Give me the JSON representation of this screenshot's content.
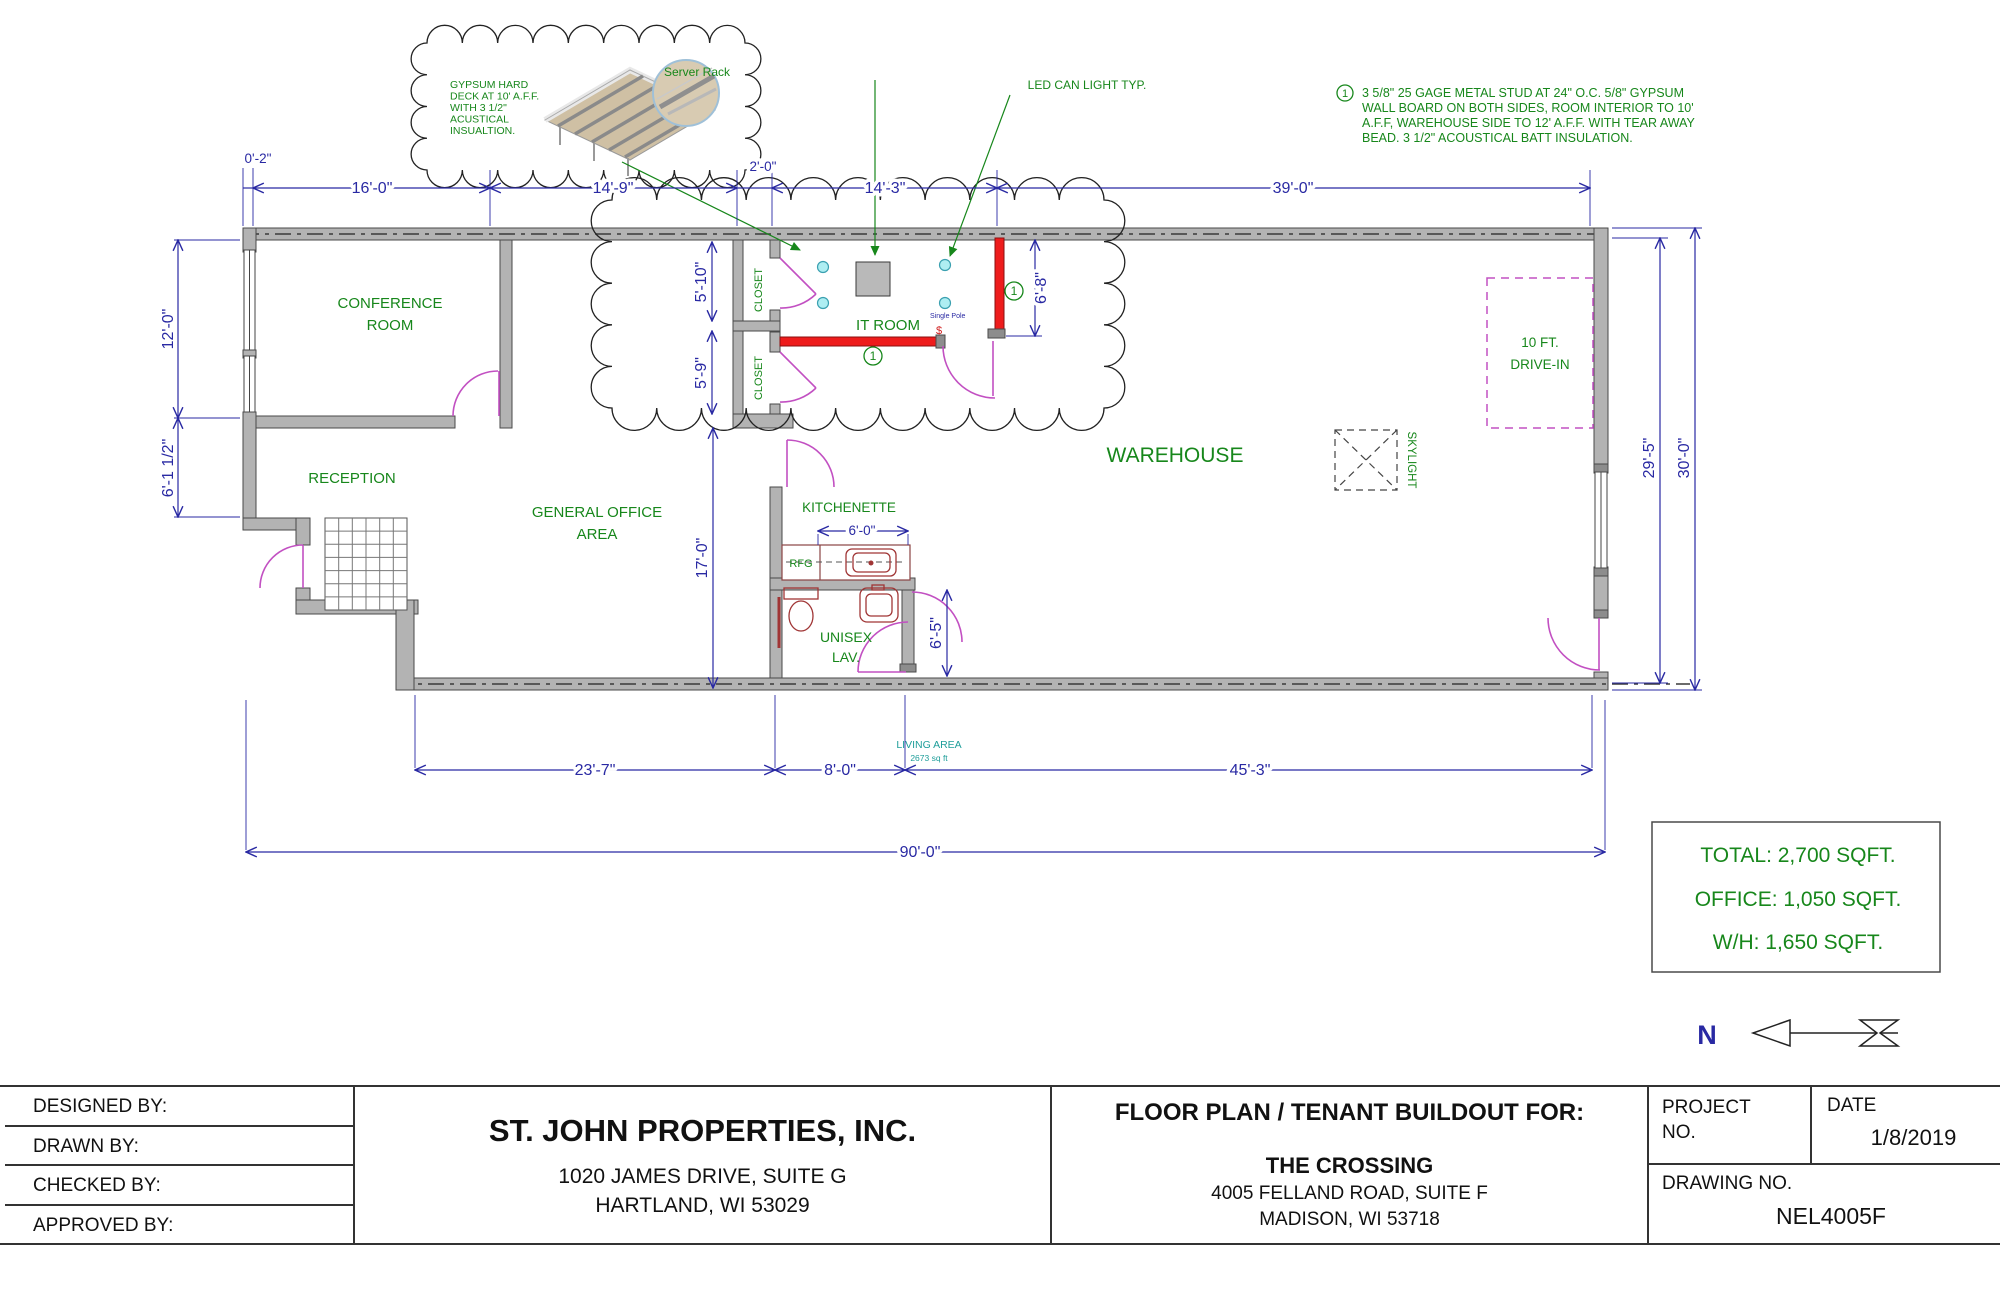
{
  "colors": {
    "green": "#17871b",
    "dim_blue": "#2929a3",
    "wall_red": "#ee1c1c",
    "door_magenta": "#c250c2",
    "teal": "#1f9e9a",
    "led_cyan": "#aeeef2"
  },
  "rooms": {
    "conference": [
      "CONFERENCE",
      "ROOM"
    ],
    "reception": "RECEPTION",
    "general_office": [
      "GENERAL OFFICE",
      "AREA"
    ],
    "closet": "CLOSET",
    "it_room": "IT ROOM",
    "kitchenette": "KITCHENETTE",
    "rfg": "RFG",
    "unisex": [
      "UNISEX",
      "LAV."
    ],
    "warehouse": "WAREHOUSE",
    "skylight": "SKYLIGHT",
    "drive_in": [
      "10 FT.",
      "DRIVE-IN"
    ]
  },
  "dims": {
    "d0_2": "0'-2\"",
    "d16": "16'-0\"",
    "d14_9": "14'-9\"",
    "d2_0": "2'-0\"",
    "d14_3": "14'-3\"",
    "d39": "39'-0\"",
    "d12": "12'-0\"",
    "d6_1h": "6'-1 1/2\"",
    "d5_10": "5'-10\"",
    "d5_9": "5'-9\"",
    "d17": "17'-0\"",
    "d6_8": "6'-8\"",
    "d6_0": "6'-0\"",
    "d6_5": "6'-5\"",
    "d29_5": "29'-5\"",
    "d30": "30'-0\"",
    "d23_7": "23'-7\"",
    "d8": "8'-0\"",
    "d45_3": "45'-3\"",
    "d90": "90'-0\""
  },
  "notes": {
    "gypsum_lines": [
      "GYPSUM HARD",
      "DECK AT 10' A.F.F.",
      "WITH 3 1/2\"",
      "ACUSTICAL",
      "INSUALTION."
    ],
    "keynote_marker": "1",
    "keynote_lines": [
      "3 5/8\" 25 GAGE METAL STUD AT 24\" O.C. 5/8\" GYPSUM",
      "WALL BOARD ON BOTH SIDES, ROOM INTERIOR TO 10'",
      "A.F.F, WAREHOUSE SIDE TO 12' A.F.F. WITH TEAR AWAY",
      "BEAD. 3 1/2\" ACOUSTICAL BATT INSULATION."
    ],
    "server_rack": "Server Rack",
    "led": "LED CAN LIGHT TYP.",
    "single_pole": "Single Pole",
    "switch_symbol": "$"
  },
  "living_area": [
    "LIVING AREA",
    "2673 sq ft"
  ],
  "area_summary": [
    "TOTAL: 2,700 SQFT.",
    "OFFICE: 1,050 SQFT.",
    "W/H: 1,650 SQFT."
  ],
  "north_label": "N",
  "titleblock": {
    "rows": [
      "DESIGNED BY:",
      "DRAWN BY:",
      "CHECKED BY:",
      "APPROVED BY:"
    ],
    "company": {
      "name": "ST. JOHN PROPERTIES, INC.",
      "addr1": "1020 JAMES DRIVE, SUITE G",
      "addr2": "HARTLAND, WI 53029"
    },
    "project": {
      "heading": "FLOOR PLAN / TENANT BUILDOUT FOR:",
      "name": "THE CROSSING",
      "addr1": "4005 FELLAND ROAD, SUITE F",
      "addr2": "MADISON, WI 53718"
    },
    "fields": {
      "project_label": "PROJECT",
      "no_label": "NO.",
      "date_label": "DATE",
      "date_value": "1/8/2019",
      "drawing_label": "DRAWING NO.",
      "drawing_value": "NEL4005F"
    }
  }
}
